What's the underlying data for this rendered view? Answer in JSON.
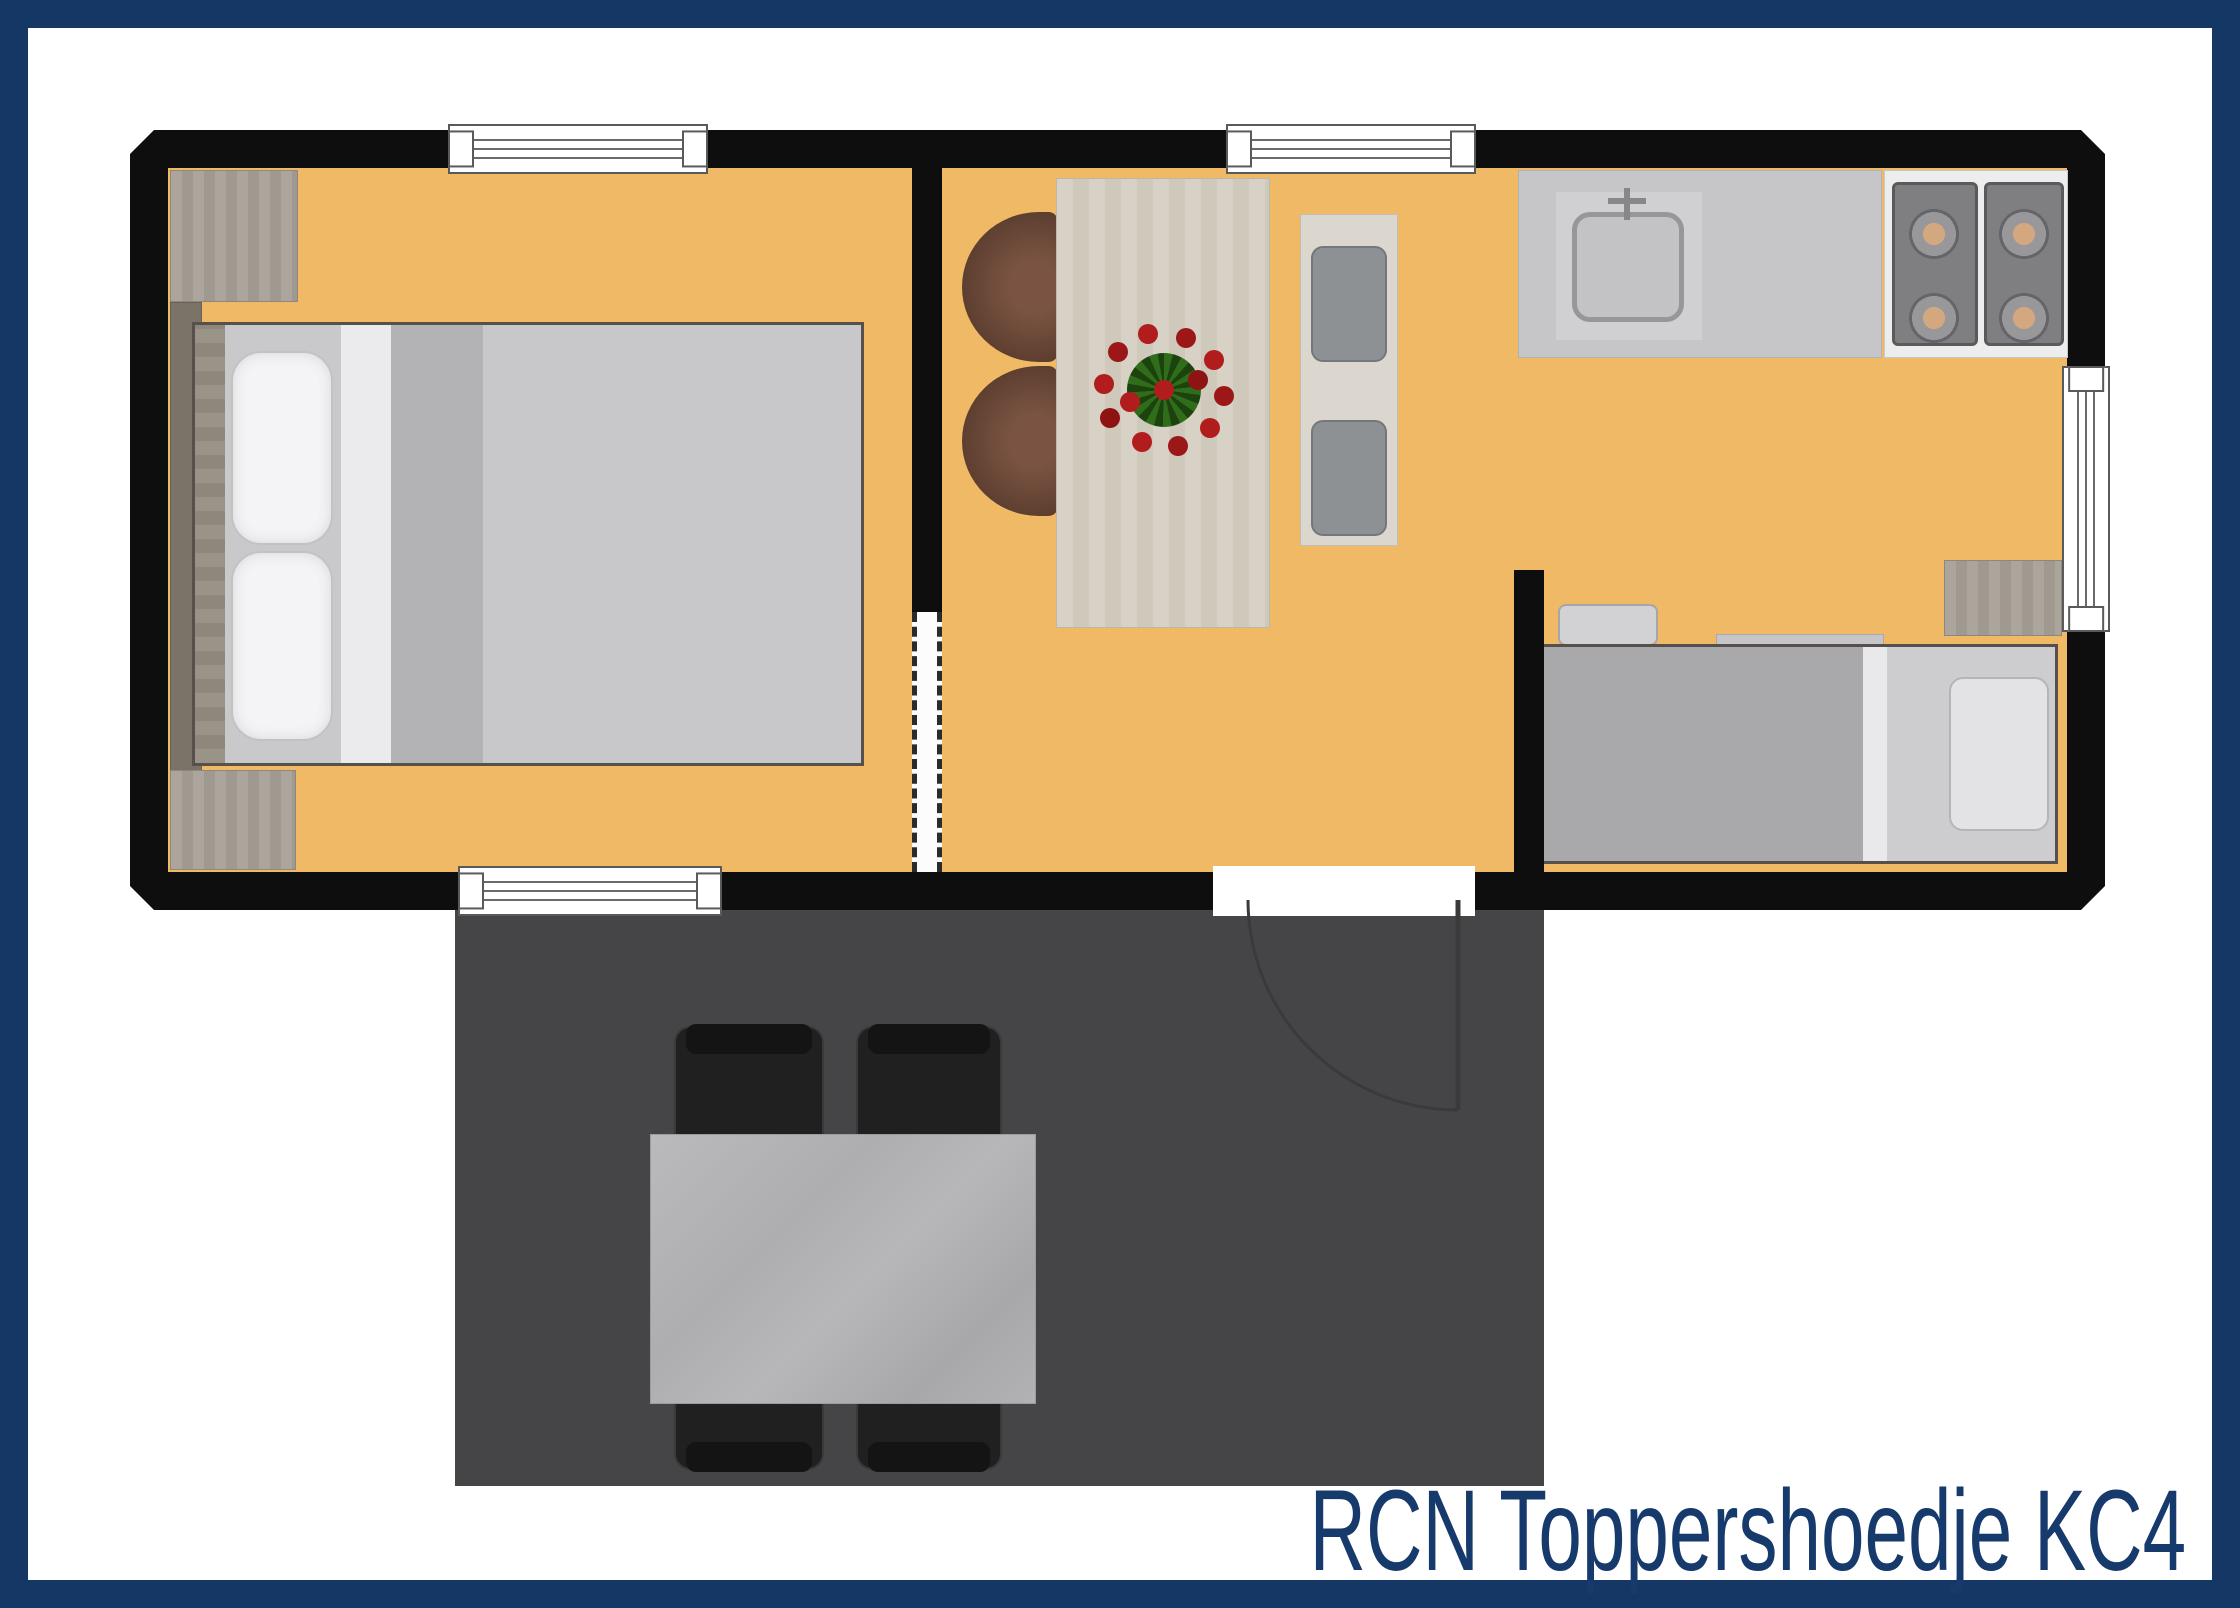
{
  "caption": {
    "text": "RCN Toppershoedje KC4",
    "color": "#163a6b"
  },
  "palette": {
    "frame_border": "#143765",
    "background": "#ffffff",
    "walls": "#0e0e0e",
    "floor": "#f0b966",
    "terrace": "#454547",
    "wood": "#a59f96",
    "counter": "#c6c6c8",
    "chair_brown": "#6b4a39",
    "flower_red": "#b11d1d",
    "flower_green": "#2f6d1a"
  },
  "floor_plan": {
    "type": "holiday-cottage-top-view",
    "rooms": [
      {
        "name": "bedroom-double"
      },
      {
        "name": "living-dining-room"
      },
      {
        "name": "kitchen"
      },
      {
        "name": "sleeping-nook"
      },
      {
        "name": "terrace"
      }
    ],
    "furniture": [
      "double-bed",
      "wardrobe-top",
      "wardrobe-bottom",
      "dining-table",
      "brown-armchairs",
      "bench-with-stools",
      "flower-centerpiece",
      "kitchen-sink",
      "stove-four-burners",
      "single-bed",
      "head-bench",
      "side-cabinet",
      "picnic-table",
      "terrace-chairs"
    ],
    "openings": [
      "window-top-bedroom",
      "window-top-living",
      "window-bottom-bedroom",
      "window-right-wall",
      "entrance-door-swing",
      "sliding-door-interior"
    ]
  }
}
